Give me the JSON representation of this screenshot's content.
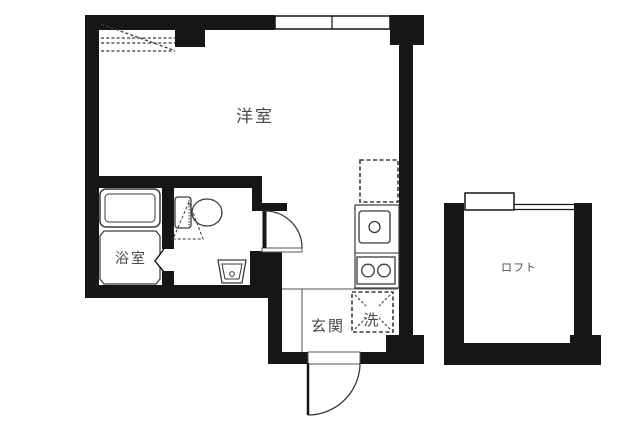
{
  "floorplan": {
    "background": "#ffffff",
    "colors": {
      "wall": "#161616",
      "fixture_line": "#3a3a3a",
      "thin_line": "#555555",
      "label": "#4a4a4a"
    },
    "rooms": {
      "western_room": {
        "label": "洋室"
      },
      "bathroom": {
        "label": "浴室"
      },
      "entrance": {
        "label": "玄関"
      },
      "washer_space": {
        "label": "洗"
      },
      "loft": {
        "label": "ロフト"
      }
    },
    "fixtures": [
      "bathtub",
      "toilet",
      "hand-basin",
      "kitchen-sink",
      "two-burner-stove",
      "refrigerator-space-dashed",
      "washing-machine-space-dashed",
      "loft-ladder-dashed"
    ],
    "doors": [
      "entrance-swing-door",
      "room-swing-door",
      "bathroom-folding-door"
    ],
    "windows": [
      "main-room-top-window",
      "loft-window"
    ]
  }
}
